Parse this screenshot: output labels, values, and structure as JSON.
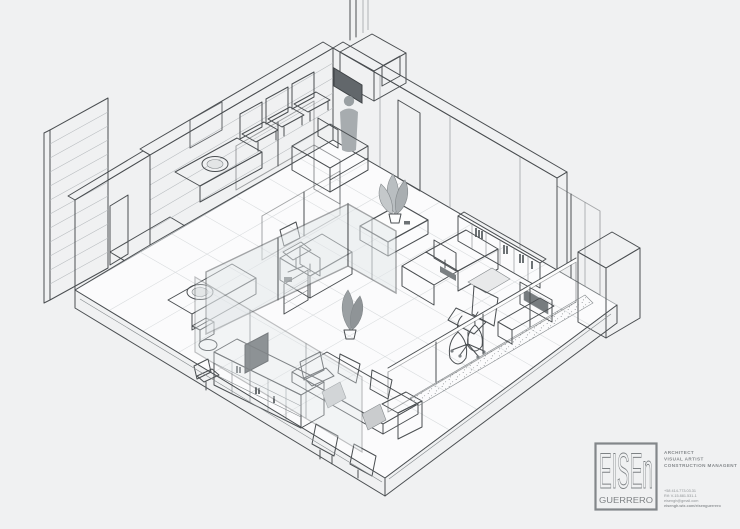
{
  "brand": {
    "name_primary": "EISEn",
    "name_secondary": "GUERRERO",
    "accent_color": "#83878a",
    "roles": [
      "ARCHITECT",
      "VISUAL ARTIST",
      "CONSTRUCTION MANAGENT"
    ],
    "contact": [
      "+58 414-773.03.31",
      "Rif: V-15.881.531-1",
      "eisengh@gmail.com",
      "eisengh.wix.com/eisenguerrero"
    ]
  }
}
